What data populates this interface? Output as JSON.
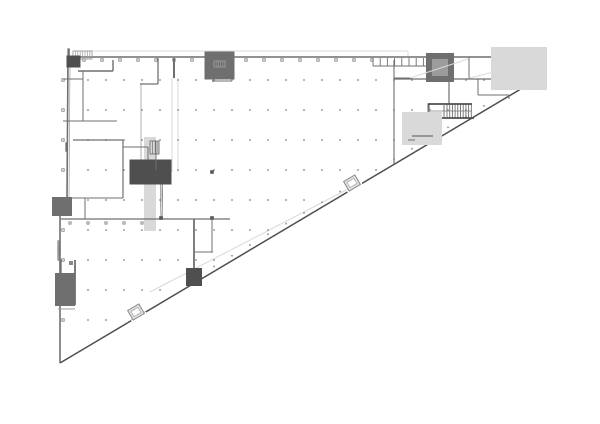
{
  "page": {
    "background": "#ffffff"
  },
  "drawing": {
    "type": "architectural-floor-plan",
    "description": "Triangular building floor plan, upper level, with structural column dot grid, stair cores and service rooms",
    "width": 600,
    "height": 424,
    "colors": {
      "wall": "#6f6f6f",
      "wallD": "#4f4f4f",
      "wallL": "#9c9c9c",
      "faint": "#d9d9d9",
      "dot": "#8f8f8f",
      "tick": "#7a7a7a",
      "fillDark": "#777777",
      "fillMid": "#9a9a9a",
      "fillLight": "#ececec",
      "fillHatch": "#c9c9c9",
      "vestFill": "#e2e2e2"
    },
    "triangle": {
      "vertex_bl": [
        60,
        363
      ],
      "vertex_tr": [
        541,
        77
      ],
      "top_left": [
        68,
        57
      ],
      "top_right": [
        542,
        57
      ]
    },
    "column_grid": {
      "x0": 70,
      "dx": 18,
      "nx": 27,
      "y0": 80,
      "dy": 30,
      "ny": 10
    },
    "elements": [
      {
        "t": "line",
        "n": "roof-outline",
        "p": [
          75,
          51,
          408,
          51
        ],
        "s": "faint"
      },
      {
        "t": "line",
        "n": "roof-outline",
        "p": [
          408,
          51,
          408,
          57
        ],
        "s": "faint"
      },
      {
        "t": "line",
        "n": "ramp-edge-line",
        "p": [
          150,
          292,
          348,
          189
        ],
        "s": "faint"
      },
      {
        "t": "rect",
        "n": "corridor-band",
        "x": 147,
        "y": 140,
        "w": 6,
        "h": 88,
        "s": "faint"
      },
      {
        "t": "line",
        "n": "corridor-wall",
        "p": [
          172,
          78,
          172,
          172
        ],
        "s": "faint"
      },
      {
        "t": "line",
        "n": "corridor-wall",
        "p": [
          178,
          78,
          178,
          172
        ],
        "s": "faint"
      },
      {
        "t": "line",
        "n": "corridor-wall",
        "p": [
          141,
          84,
          141,
          172
        ],
        "s": "wallL",
        "w": 0.8
      },
      {
        "t": "line",
        "n": "left-wall-inner",
        "p": [
          70,
          64,
          69,
          198
        ],
        "s": "wallL",
        "w": 0.7
      },
      {
        "t": "griddots",
        "n": "column-grid-dots",
        "x0": 70,
        "dx": 18,
        "nx": 27,
        "y0": 80,
        "dy": 30,
        "ny": 10,
        "sz": 1.6
      },
      {
        "t": "diagdots",
        "n": "diagonal-column-dots",
        "x0": 214,
        "d": 18,
        "nIt": 16,
        "off": 5,
        "sz": 1.6
      },
      {
        "t": "ticks",
        "n": "top-wall-column-ticks",
        "o": "h",
        "x0": 84,
        "d": 18,
        "nIt": 17,
        "y": 60,
        "sz": 2.4
      },
      {
        "t": "ticks",
        "n": "left-wall-column-ticks",
        "o": "v",
        "y0": 80,
        "d": 30,
        "nIt": 9,
        "x": 63,
        "sz": 2.4
      },
      {
        "t": "ticks",
        "n": "mid-wall-column-ticks",
        "o": "h",
        "x0": 70,
        "d": 18,
        "nIt": 5,
        "y": 223,
        "sz": 2.2
      },
      {
        "t": "pline",
        "n": "left-outer-wall",
        "pts": [
          [
            68,
            57
          ],
          [
            67,
            198
          ],
          [
            60,
            200
          ],
          [
            60,
            363
          ]
        ],
        "s": "wall",
        "w": 1.6
      },
      {
        "t": "line",
        "n": "top-outer-wall",
        "p": [
          68,
          57,
          542,
          57
        ],
        "s": "wall",
        "w": 1.4
      },
      {
        "t": "rect",
        "n": "right-end-wall",
        "x": 536,
        "y": 58,
        "w": 5,
        "h": 20,
        "s": "wallD",
        "f": "#6f6f6f"
      },
      {
        "t": "line",
        "n": "hypotenuse-wall",
        "p": [
          60,
          363,
          541,
          77
        ],
        "s": "wallD",
        "w": 1.5
      },
      {
        "t": "rect",
        "n": "corner-stair-room",
        "x": 68,
        "y": 49,
        "w": 1.2,
        "h": 17,
        "s": "wall"
      },
      {
        "t": "hatch",
        "n": "corner-stair-treads",
        "x": 73,
        "y": 51,
        "w": 19,
        "h": 8,
        "step": 2.4,
        "s": "wallL"
      },
      {
        "t": "rect",
        "n": "corner-shaft",
        "x": 70,
        "y": 59,
        "w": 7,
        "h": 5,
        "s": "wallD",
        "f": "#9a9a9a"
      },
      {
        "t": "line",
        "p": [
          78,
          71,
          113,
          71
        ],
        "s": "wall",
        "w": 1.4
      },
      {
        "t": "line",
        "p": [
          113,
          60,
          113,
          71
        ],
        "s": "wall",
        "w": 1.4
      },
      {
        "t": "line",
        "p": [
          63,
          79,
          83,
          79
        ],
        "s": "wall"
      },
      {
        "t": "line",
        "p": [
          83,
          71,
          83,
          121
        ],
        "s": "wall"
      },
      {
        "t": "line",
        "p": [
          63,
          121,
          117,
          121
        ],
        "s": "wall"
      },
      {
        "t": "line",
        "p": [
          73,
          140,
          123,
          140
        ],
        "s": "wall",
        "w": 1.2
      },
      {
        "t": "rect",
        "n": "wall-pier",
        "x": 66,
        "y": 143,
        "w": 1.3,
        "h": 8,
        "s": "wall"
      },
      {
        "t": "line",
        "p": [
          123,
          140,
          123,
          198
        ],
        "s": "wall",
        "w": 1.2
      },
      {
        "t": "line",
        "p": [
          123,
          147,
          148,
          147
        ],
        "s": "wall"
      },
      {
        "t": "line",
        "p": [
          148,
          147,
          148,
          172
        ],
        "s": "wall"
      },
      {
        "t": "line",
        "p": [
          63,
          198,
          123,
          198
        ],
        "s": "wall"
      },
      {
        "t": "line",
        "p": [
          85,
          198,
          85,
          219
        ],
        "s": "wall"
      },
      {
        "t": "line",
        "n": "hall-edge-wall",
        "p": [
          61,
          219,
          230,
          219
        ],
        "s": "wall",
        "w": 1.3
      },
      {
        "t": "rect",
        "n": "wall-pier",
        "x": 57,
        "y": 202,
        "w": 10,
        "h": 9,
        "s": "wall"
      },
      {
        "t": "line",
        "p": [
          158,
          58,
          158,
          84
        ],
        "s": "wall",
        "w": 1.3
      },
      {
        "t": "line",
        "p": [
          140,
          84,
          158,
          84
        ],
        "s": "wall",
        "w": 1.3
      },
      {
        "t": "line",
        "p": [
          174,
          58,
          174,
          78
        ],
        "s": "wall",
        "w": 2
      },
      {
        "t": "rect",
        "n": "duct-room",
        "x": 212,
        "y": 59,
        "w": 15,
        "h": 13,
        "s": "wall",
        "f": "#ececec"
      },
      {
        "t": "hatch",
        "n": "duct-room-hatch",
        "x": 214,
        "y": 61,
        "w": 11,
        "h": 6,
        "step": 2.2,
        "s": "wallL"
      },
      {
        "t": "line",
        "p": [
          213,
          72,
          213,
          82
        ],
        "s": "wall"
      },
      {
        "t": "line",
        "p": [
          212,
          81,
          232,
          81
        ],
        "s": "wall"
      },
      {
        "t": "xbox",
        "n": "stair-core",
        "x": 161,
        "y": 172,
        "w": 1.2,
        "h": 46,
        "s": "wall",
        "xs": "faint"
      },
      {
        "t": "sq",
        "n": "core-columns",
        "pts": [
          [
            161,
            172
          ],
          [
            212,
            172
          ],
          [
            161,
            218
          ],
          [
            212,
            218
          ]
        ],
        "sz": 3.6,
        "f": "#555555"
      },
      {
        "t": "rect",
        "n": "core-wall-chunk",
        "x": 140,
        "y": 170,
        "w": 21,
        "h": 4,
        "s": "wallD",
        "f": "#5a5a5a"
      },
      {
        "t": "hatch",
        "n": "core-stair-treads",
        "x": 150,
        "y": 141,
        "w": 9,
        "h": 13,
        "step": 2.6,
        "s": "wall"
      },
      {
        "t": "line",
        "p": [
          156,
          141,
          156,
          170
        ],
        "s": "wall"
      },
      {
        "t": "line",
        "p": [
          194,
          219,
          194,
          278
        ],
        "s": "wall",
        "w": 1.8
      },
      {
        "t": "rect",
        "n": "wall-end-cap",
        "x": 190,
        "y": 272,
        "w": 8,
        "h": 10,
        "s": "wallD",
        "f": "#777777"
      },
      {
        "t": "line",
        "p": [
          212,
          218,
          212,
          252
        ],
        "s": "wall"
      },
      {
        "t": "line",
        "p": [
          194,
          252,
          213,
          252
        ],
        "s": "wall"
      },
      {
        "t": "xbox",
        "n": "elevator-shaft",
        "x": 58,
        "y": 241,
        "w": 1.1,
        "h": 19,
        "s": "wall",
        "xs": "wallL"
      },
      {
        "t": "rect",
        "n": "west-stair-room",
        "x": 60,
        "y": 260,
        "w": 1.1,
        "h": 45,
        "s": "wall"
      },
      {
        "t": "line",
        "p": [
          75,
          260,
          75,
          305
        ],
        "s": "wall",
        "w": 1.8
      },
      {
        "t": "rect",
        "n": "stair-landing",
        "x": 60,
        "y": 278,
        "w": 10,
        "h": 8,
        "s": "wall"
      },
      {
        "t": "rect",
        "n": "stair-landing",
        "x": 60,
        "y": 286,
        "w": 10,
        "h": 8,
        "s": "wall"
      },
      {
        "t": "rect",
        "n": "stair-landing",
        "x": 60,
        "y": 294,
        "w": 10,
        "h": 7,
        "s": "wall",
        "f": "#c9c9c9"
      },
      {
        "t": "sq",
        "n": "room-column",
        "pts": [
          [
            71,
            263
          ]
        ],
        "sz": 4,
        "f": "#888888"
      },
      {
        "t": "line",
        "p": [
          58,
          309,
          75,
          309
        ],
        "s": "wallL"
      },
      {
        "t": "line",
        "n": "mid-partition",
        "p": [
          394,
          60,
          394,
          164
        ],
        "s": "wall",
        "w": 1.1
      },
      {
        "t": "line",
        "p": [
          394,
          78,
          412,
          78
        ],
        "s": "wall"
      },
      {
        "t": "line",
        "n": "louvre-strip",
        "p": [
          373,
          66,
          430,
          66
        ],
        "s": "wall"
      },
      {
        "t": "vlines",
        "n": "louvre-fins",
        "x0": 373,
        "d": 7.2,
        "nIt": 9,
        "y1": 58,
        "y2": 66,
        "s": "wall"
      },
      {
        "t": "line",
        "p": [
          430,
          57,
          430,
          79
        ],
        "s": "wall"
      },
      {
        "t": "rect",
        "n": "service-room",
        "x": 433,
        "y": 60,
        "w": 14,
        "h": 15,
        "s": "wall"
      },
      {
        "t": "rect",
        "n": "service-room-inner",
        "x": 436,
        "y": 63,
        "w": 8,
        "h": 9,
        "s": "wallL"
      },
      {
        "t": "line",
        "p": [
          449,
          57,
          449,
          104
        ],
        "s": "wall",
        "w": 1.2
      },
      {
        "t": "line",
        "p": [
          469,
          57,
          469,
          79
        ],
        "s": "wall"
      },
      {
        "t": "line",
        "p": [
          503,
          57,
          503,
          79
        ],
        "s": "wall"
      },
      {
        "t": "line",
        "n": "band-bottom-wall",
        "p": [
          394,
          79,
          537,
          79
        ],
        "s": "wall",
        "w": 1.2
      },
      {
        "t": "line",
        "p": [
          478,
          79,
          478,
          95
        ],
        "s": "wall"
      },
      {
        "t": "line",
        "p": [
          478,
          95,
          509,
          95
        ],
        "s": "wall"
      },
      {
        "t": "line",
        "p": [
          509,
          95,
          509,
          99
        ],
        "s": "wall"
      },
      {
        "t": "rect",
        "n": "east-room-outline",
        "x": 505,
        "y": 61,
        "w": 28,
        "h": 15,
        "s": "faint"
      },
      {
        "t": "line",
        "n": "ramp-line",
        "p": [
          410,
          78,
          468,
          59
        ],
        "s": "faint"
      },
      {
        "t": "line",
        "n": "ramp-line",
        "p": [
          470,
          78,
          536,
          61
        ],
        "s": "faint"
      },
      {
        "t": "rect",
        "n": "east-stair",
        "x": 428,
        "y": 104,
        "w": 1.1,
        "h": 14,
        "s": "wall"
      },
      {
        "t": "line",
        "p": [
          428,
          111,
          472,
          111
        ],
        "s": "wallL"
      },
      {
        "t": "vlines",
        "n": "east-stair-treads",
        "x0": 447,
        "d": 2.7,
        "nIt": 10,
        "y1": 104,
        "y2": 118,
        "s": "wall"
      },
      {
        "t": "line",
        "p": [
          428,
          104,
          472,
          104
        ],
        "s": "wallD",
        "w": 1.8
      },
      {
        "t": "line",
        "p": [
          428,
          118,
          474,
          118
        ],
        "s": "wallD",
        "w": 1.8
      },
      {
        "t": "line",
        "p": [
          444,
          104,
          444,
          118
        ],
        "s": "wall"
      },
      {
        "t": "rect",
        "n": "diagonal-service-room",
        "x": 405,
        "y": 119,
        "w": 1.2,
        "h": 12,
        "s": "wall"
      },
      {
        "t": "rect",
        "n": "diagonal-room-outline",
        "x": 412,
        "y": 122,
        "w": 20,
        "h": 13,
        "s": "faint"
      },
      {
        "t": "line",
        "p": [
          412,
          136,
          433,
          136
        ],
        "s": "wall",
        "w": 1.2
      },
      {
        "t": "line",
        "p": [
          408,
          140,
          415,
          140
        ],
        "s": "wall"
      },
      {
        "t": "vest",
        "n": "entrance-vestibule-mid",
        "cx": 352,
        "cy": 183,
        "w": 13,
        "h": 11,
        "a": -30.5
      },
      {
        "t": "vest",
        "n": "entrance-vestibule-south",
        "cx": 136,
        "cy": 312,
        "w": 13,
        "h": 11,
        "a": -30.5
      }
    ]
  }
}
